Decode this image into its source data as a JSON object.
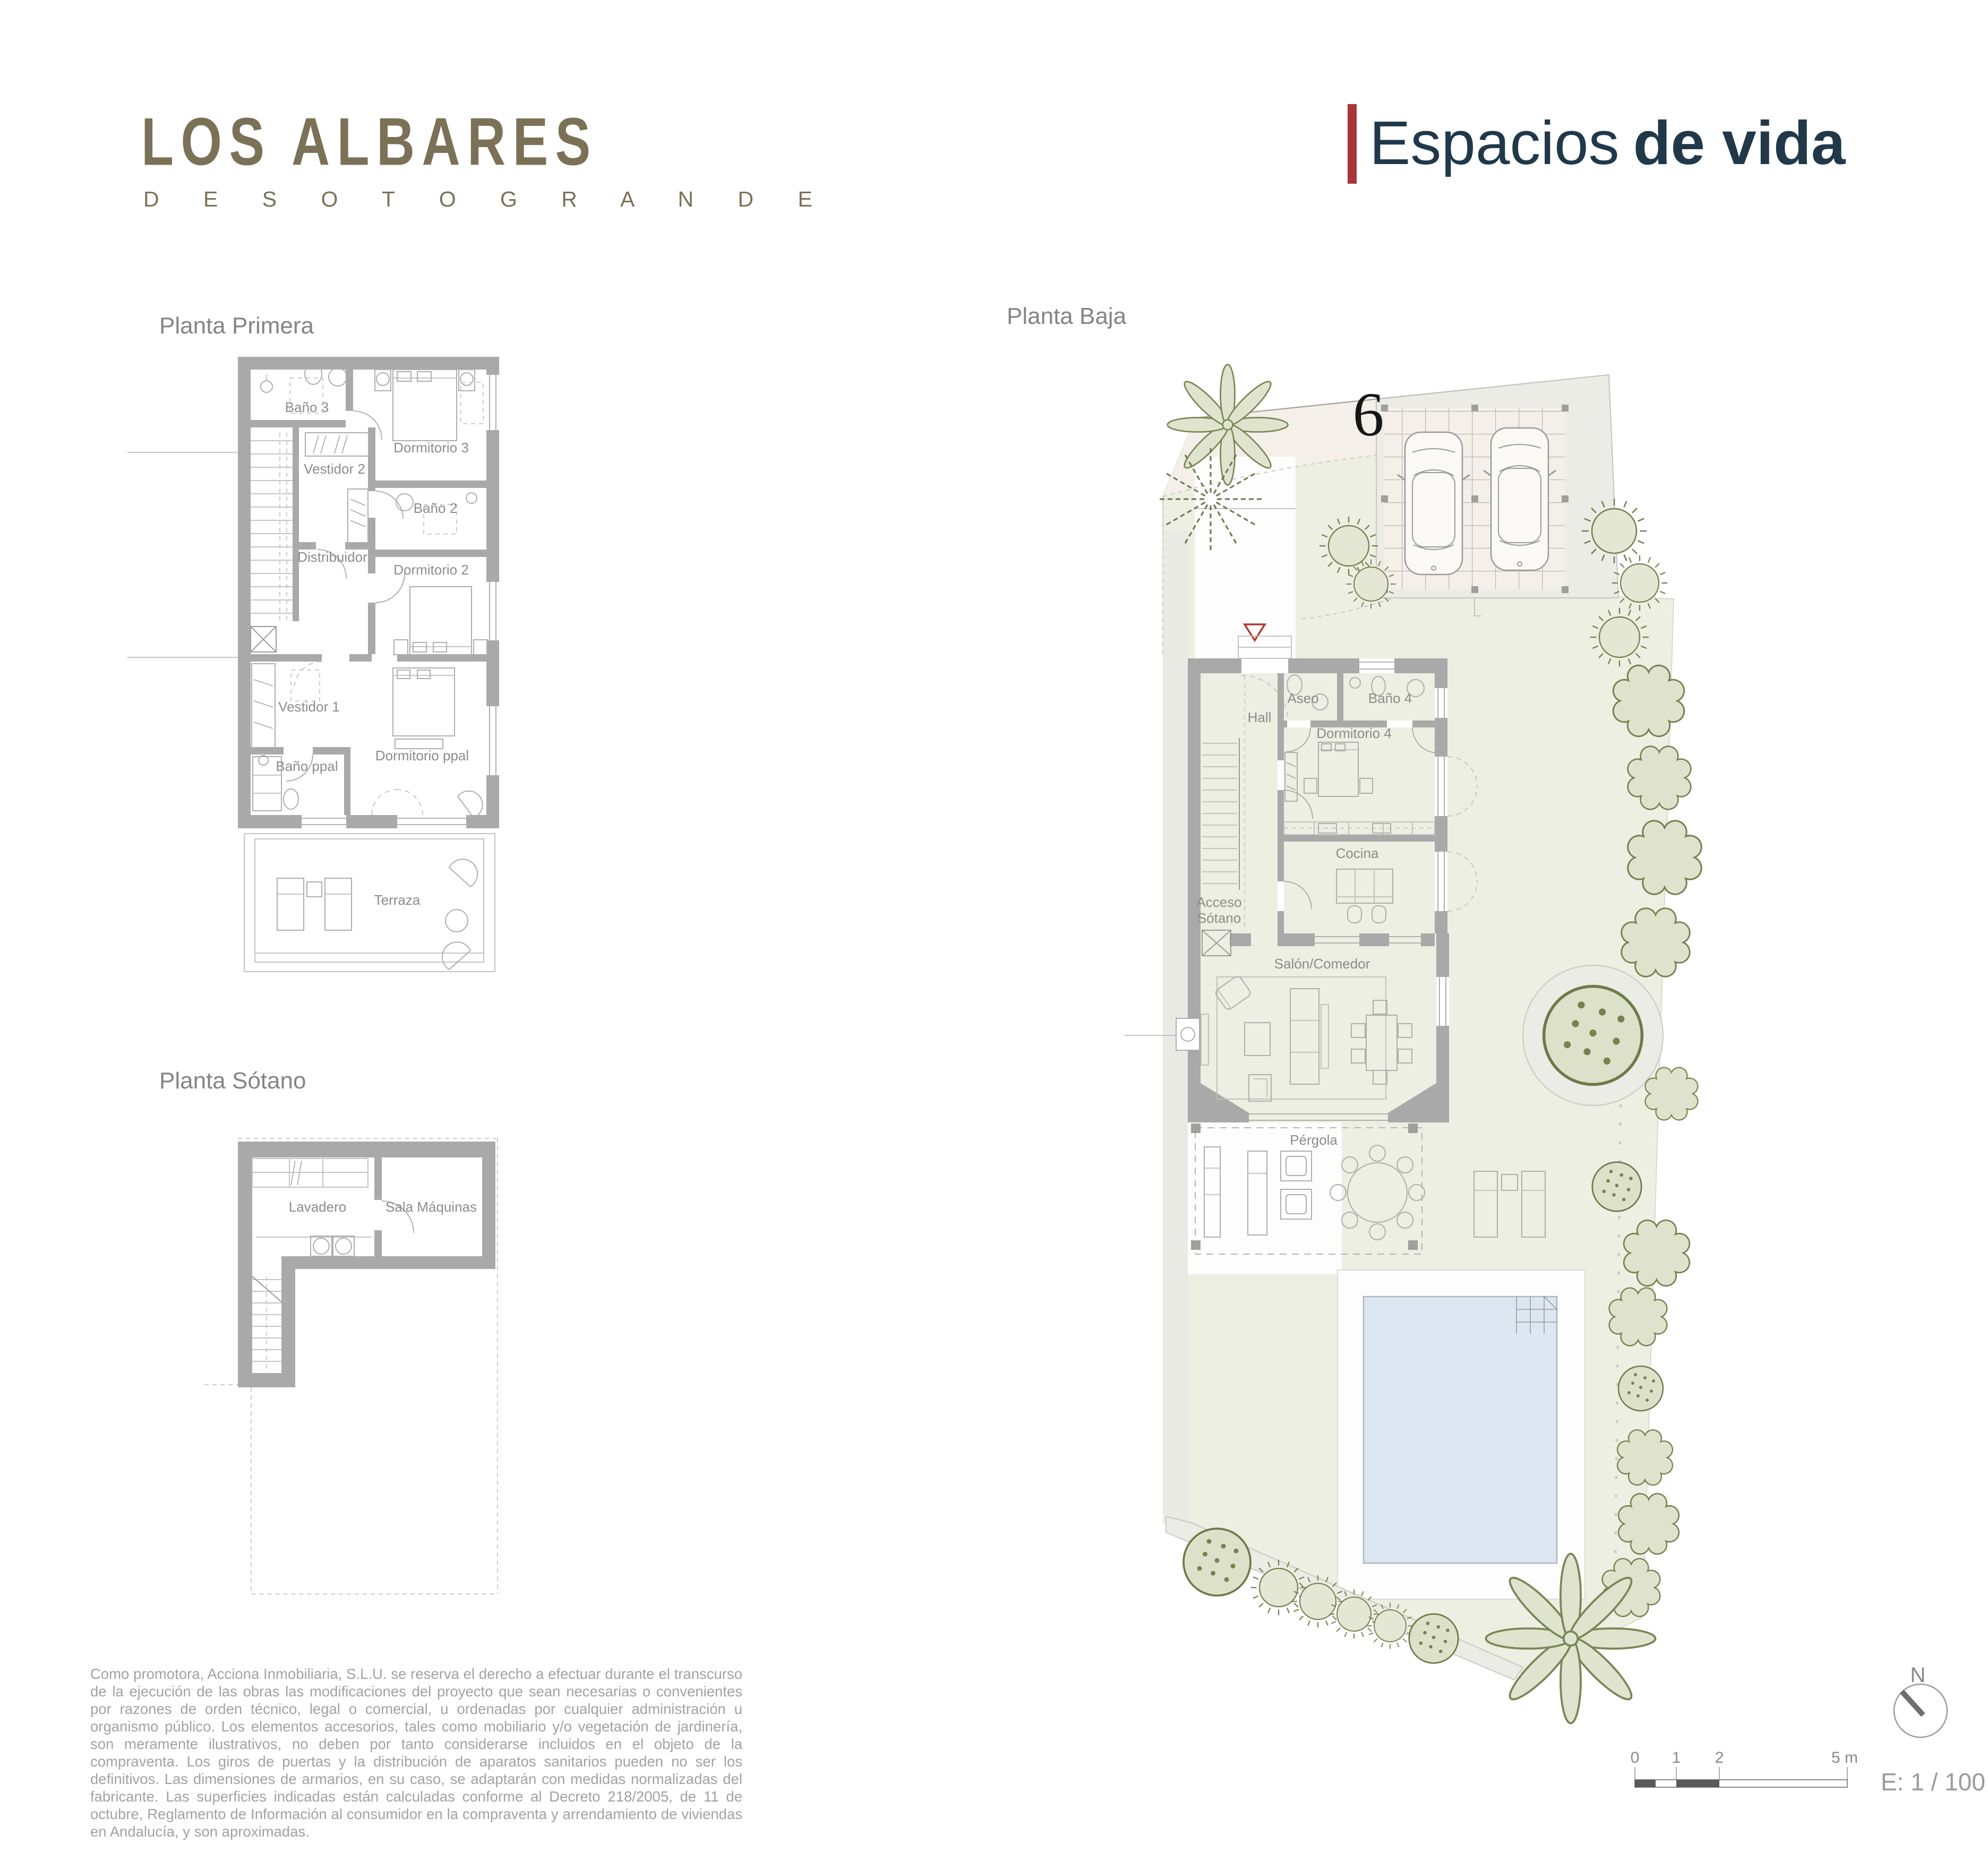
{
  "brand": {
    "title": "LOS ALBARES",
    "subtitle": "D E   S O T O G R A N D E",
    "tagline_light": "Espacios",
    "tagline_bold": "de vida"
  },
  "plans": {
    "primera": {
      "title": "Planta Primera",
      "rooms": {
        "bano3": "Baño 3",
        "dormitorio3": "Dormitorio 3",
        "vestidor2": "Vestidor 2",
        "bano2": "Baño 2",
        "distribuidor": "Distribuidor",
        "dormitorio2": "Dormitorio 2",
        "vestidor1": "Vestidor 1",
        "bano_ppal": "Baño ppal",
        "dormitorio_ppal": "Dormitorio ppal",
        "terraza": "Terraza"
      }
    },
    "sotano": {
      "title": "Planta Sótano",
      "rooms": {
        "lavadero": "Lavadero",
        "sala_maquinas": "Sala Máquinas"
      }
    },
    "baja": {
      "title": "Planta Baja",
      "plot_number": "6",
      "rooms": {
        "aseo": "Aseo",
        "bano4": "Baño 4",
        "hall": "Hall",
        "dormitorio4": "Dormitorio 4",
        "cocina": "Cocina",
        "acceso_line1": "Acceso",
        "acceso_line2": "Sótano",
        "salon_comedor": "Salón/Comedor",
        "pergola": "Pérgola"
      }
    }
  },
  "legend": {
    "north": "N",
    "scale": "E: 1 / 100",
    "ticks": [
      "0",
      "1",
      "2",
      "5 m"
    ]
  },
  "footer": {
    "disclaimer": "Como promotora, Acciona Inmobiliaria, S.L.U. se reserva el derecho a efectuar durante el transcurso de la ejecución de las obras las modificaciones del proyecto que sean necesarias o convenientes por razones de orden técnico, legal o comercial, u ordenadas por cualquier administración u organismo público. Los elementos accesorios, tales como mobiliario y/o vegetación de jardinería, son meramente ilustrativos, no deben por tanto considerarse incluidos en el objeto de la compraventa. Los giros de puertas y la distribución de aparatos sanitarios pueden no ser los definitivos. Las dimensiones de armarios, en su caso, se adaptarán con medidas normalizadas del fabricante. Las superficies indicadas están calculadas conforme al Decreto 218/2005, de 11 de octubre, Reglamento de Información al consumidor en la compraventa y arrendamiento de viviendas en Andalucía, y son aproximadas."
  },
  "colors": {
    "brand_olive": "#7a7157",
    "tagline_navy": "#20384a",
    "accent_red": "#a93439",
    "wall_gray": "#a9a9a9",
    "garden_green": "#ecefe1",
    "street_beige": "#f4efe8",
    "pool_blue": "#dce7f1",
    "tree_olive": "#76814f"
  }
}
